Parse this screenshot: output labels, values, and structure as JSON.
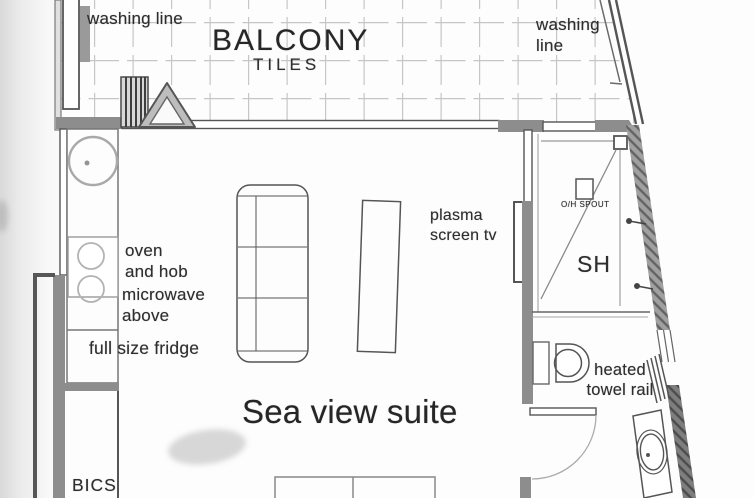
{
  "title": "Sea view suite",
  "labels": {
    "washing_line_left": "washing line",
    "balcony": "BALCONY",
    "tiles": "TILES",
    "washing_line_right": "washing\nline",
    "oven_and_hob": "oven\nand hob",
    "microwave_above": "microwave\nabove",
    "full_size_fridge": "full size fridge",
    "plasma_screen_tv": "plasma\nscreen tv",
    "oh_spout": "O/H SPOUT",
    "shower": "SH",
    "heated_towel_rail": "heated\ntowel rail",
    "suite_name": "Sea view suite",
    "bics": "BICS"
  },
  "colors": {
    "paper": "#fdfdfd",
    "line_dark": "#4a4a4a",
    "wall_grey": "#8d8d8d",
    "tile_line": "#c6c6c6"
  }
}
